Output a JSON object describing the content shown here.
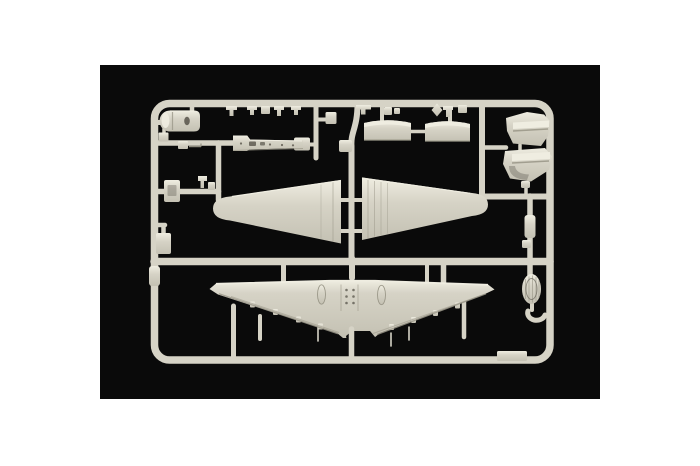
{
  "meta": {
    "description": "Product photograph of an injection-moulded model-kit sprue (light grey styrene) with aircraft parts, shot on a black background with white page margins"
  },
  "colors": {
    "page_background": "#ffffff",
    "photo_background": "#0a0a0a",
    "sprue_base": "#d6d3c6",
    "sprue_light": "#efede1",
    "sprue_mid": "#c4c1b3",
    "sprue_shadow": "#9b9889",
    "sprue_dark": "#57544a"
  },
  "parts": {
    "frame": "sprue-runner-frame",
    "nose_cowling": "engine-cowling-piece",
    "keel": "fuselage-keel-strip",
    "panel_a": "cowl-panel-left",
    "panel_b": "cowl-panel-right",
    "nacelle_upper": "engine-nacelle-half-upper",
    "nacelle_lower": "engine-nacelle-half-lower",
    "fuselage_left": "fuselage-half-left",
    "fuselage_right": "fuselage-half-right",
    "wing": "one-piece-wing",
    "wheel": "main-wheel",
    "wheel_cover": "wheel-cover-crescent",
    "small_parts": "assorted-small-detail-parts"
  }
}
